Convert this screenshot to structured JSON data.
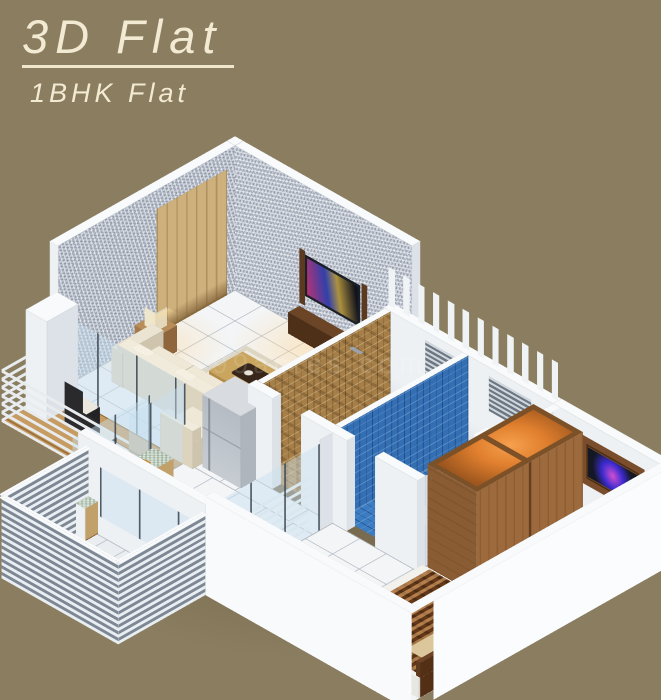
{
  "header": {
    "title": "3D Flat",
    "subtitle": "1BHK Flat"
  },
  "watermark": "99acres.com",
  "palette": {
    "background": "#8b7d5f",
    "title_text": "#f2ead2",
    "stone_wall": "#c3c9d4",
    "white_wall": "#f2f5f7",
    "floor_tile": "#f3f5f7",
    "brown_mosaic": "#b08a50",
    "blue_mosaic": "#3c7cc2",
    "wood": "#9a6b40",
    "deck_wood": "#c79c63",
    "granite_counter": "#dde6dd",
    "sofa_cream": "#e8e0cd",
    "bed_cover": "#7c4a22",
    "wardrobe_glow": "#e07f2e"
  }
}
